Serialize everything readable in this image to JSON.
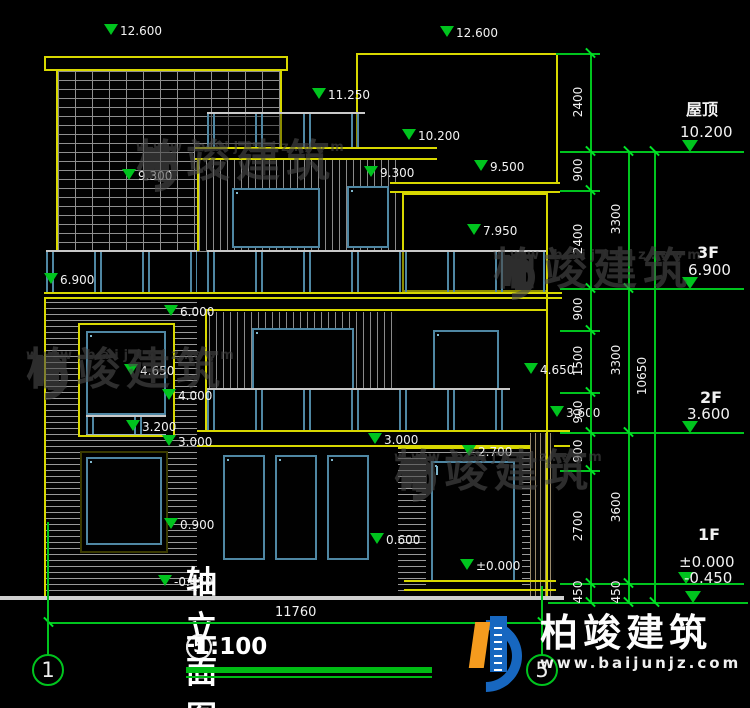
{
  "colors": {
    "cad_yellow": "#d8d800",
    "cad_green": "#00c41e",
    "frame_blue": "#4f87a3",
    "frame_light": "#7fb6cc",
    "text_white": "#f2f2f2"
  },
  "title": {
    "axis_from": "1",
    "axis_to": "5",
    "dash": "-",
    "name": "轴立面图",
    "scale": "1:100"
  },
  "ground_dimension": {
    "label": "11760",
    "y": 622,
    "x1": 48,
    "x2": 542,
    "text_x": 275,
    "text_y": 605
  },
  "axis_bubbles": [
    {
      "n": "1",
      "x": 32,
      "y": 654
    },
    {
      "n": "5",
      "x": 526,
      "y": 654
    }
  ],
  "axis_lines": [
    {
      "x": 47,
      "y1": 522,
      "y2": 655
    },
    {
      "x": 541,
      "y1": 586,
      "y2": 655
    }
  ],
  "elevation_markers": [
    {
      "v": "12.600",
      "x": 92,
      "y": 24
    },
    {
      "v": "12.600",
      "x": 428,
      "y": 26
    },
    {
      "v": "11.250",
      "x": 300,
      "y": 88
    },
    {
      "v": "10.200",
      "x": 390,
      "y": 129
    },
    {
      "v": "9.500",
      "x": 462,
      "y": 160
    },
    {
      "v": "9.300",
      "x": 110,
      "y": 169
    },
    {
      "v": "9.300",
      "x": 352,
      "y": 166
    },
    {
      "v": "7.950",
      "x": 455,
      "y": 224
    },
    {
      "v": "6.900",
      "x": 32,
      "y": 273
    },
    {
      "v": "6.000",
      "x": 152,
      "y": 305
    },
    {
      "v": "4.650",
      "x": 112,
      "y": 364
    },
    {
      "v": "4.000",
      "x": 150,
      "y": 389
    },
    {
      "v": "3.200",
      "x": 114,
      "y": 420
    },
    {
      "v": "3.000",
      "x": 150,
      "y": 435
    },
    {
      "v": "3.000",
      "x": 356,
      "y": 433
    },
    {
      "v": "2.700",
      "x": 450,
      "y": 445
    },
    {
      "v": "4.650",
      "x": 512,
      "y": 363
    },
    {
      "v": "3.600",
      "x": 538,
      "y": 406
    },
    {
      "v": "0.900",
      "x": 152,
      "y": 518
    },
    {
      "v": "0.600",
      "x": 358,
      "y": 533
    },
    {
      "v": "±0.000",
      "x": 448,
      "y": 559
    },
    {
      "v": "-0.450",
      "x": 146,
      "y": 575
    }
  ],
  "floor_levels": [
    {
      "label": "屋顶",
      "value": "10.200",
      "line_y": 151,
      "tri_x": 682,
      "label_x": 686,
      "label_y": 96,
      "val_x": 680,
      "val_y": 123
    },
    {
      "label": "3F",
      "value": "6.900",
      "line_y": 288,
      "tri_x": 682,
      "label_x": 697,
      "label_y": 243,
      "val_x": 688,
      "val_y": 261
    },
    {
      "label": "2F",
      "value": "3.600",
      "line_y": 432,
      "tri_x": 682,
      "label_x": 700,
      "label_y": 388,
      "val_x": 687,
      "val_y": 405
    },
    {
      "label": "1F",
      "value": "±0.000",
      "line_y": 583,
      "tri_x": 678,
      "label_x": 698,
      "label_y": 525,
      "val_x": 679,
      "val_y": 553
    },
    {
      "label": "",
      "value": "-0.450",
      "line_y": 602,
      "tri_x": 685,
      "label_x": 0,
      "label_y": 0,
      "val_x": 684,
      "val_y": 569
    }
  ],
  "dim_chains": [
    {
      "x": 590,
      "ticks": [
        53,
        151,
        190,
        288,
        330,
        392,
        432,
        470,
        583,
        602
      ],
      "labels": [
        {
          "t": "2400",
          "y": 102
        },
        {
          "t": "900",
          "y": 170
        },
        {
          "t": "2400",
          "y": 239
        },
        {
          "t": "900",
          "y": 309
        },
        {
          "t": "1500",
          "y": 361
        },
        {
          "t": "900",
          "y": 412
        },
        {
          "t": "900",
          "y": 451
        },
        {
          "t": "2700",
          "y": 526
        },
        {
          "t": "450",
          "y": 592
        }
      ]
    },
    {
      "x": 628,
      "ticks": [
        151,
        288,
        432,
        583,
        602
      ],
      "labels": [
        {
          "t": "3300",
          "y": 219
        },
        {
          "t": "3300",
          "y": 360
        },
        {
          "t": "3600",
          "y": 507
        },
        {
          "t": "450",
          "y": 592
        }
      ]
    },
    {
      "x": 654,
      "ticks": [
        151,
        602
      ],
      "labels": [
        {
          "t": "10650",
          "y": 376
        }
      ]
    }
  ],
  "ext_lines": [
    {
      "y": 53,
      "x1": 556,
      "x2": 600
    },
    {
      "y": 151,
      "x1": 560,
      "x2": 744
    },
    {
      "y": 190,
      "x1": 560,
      "x2": 600
    },
    {
      "y": 288,
      "x1": 560,
      "x2": 744
    },
    {
      "y": 330,
      "x1": 560,
      "x2": 600
    },
    {
      "y": 392,
      "x1": 560,
      "x2": 600
    },
    {
      "y": 432,
      "x1": 560,
      "x2": 744
    },
    {
      "y": 470,
      "x1": 560,
      "x2": 600
    },
    {
      "y": 583,
      "x1": 560,
      "x2": 744
    },
    {
      "y": 602,
      "x1": 548,
      "x2": 748
    }
  ],
  "watermark": {
    "name": "柏竣建筑",
    "url": "www.baijunjz.com"
  },
  "watermark_positions": [
    {
      "x": 130,
      "y": 140
    },
    {
      "x": 487,
      "y": 248
    },
    {
      "x": 20,
      "y": 348
    },
    {
      "x": 388,
      "y": 450
    }
  ],
  "logo": {
    "name": "柏竣建筑",
    "url": "www.baijunjz.com",
    "x": 448,
    "y": 612
  }
}
